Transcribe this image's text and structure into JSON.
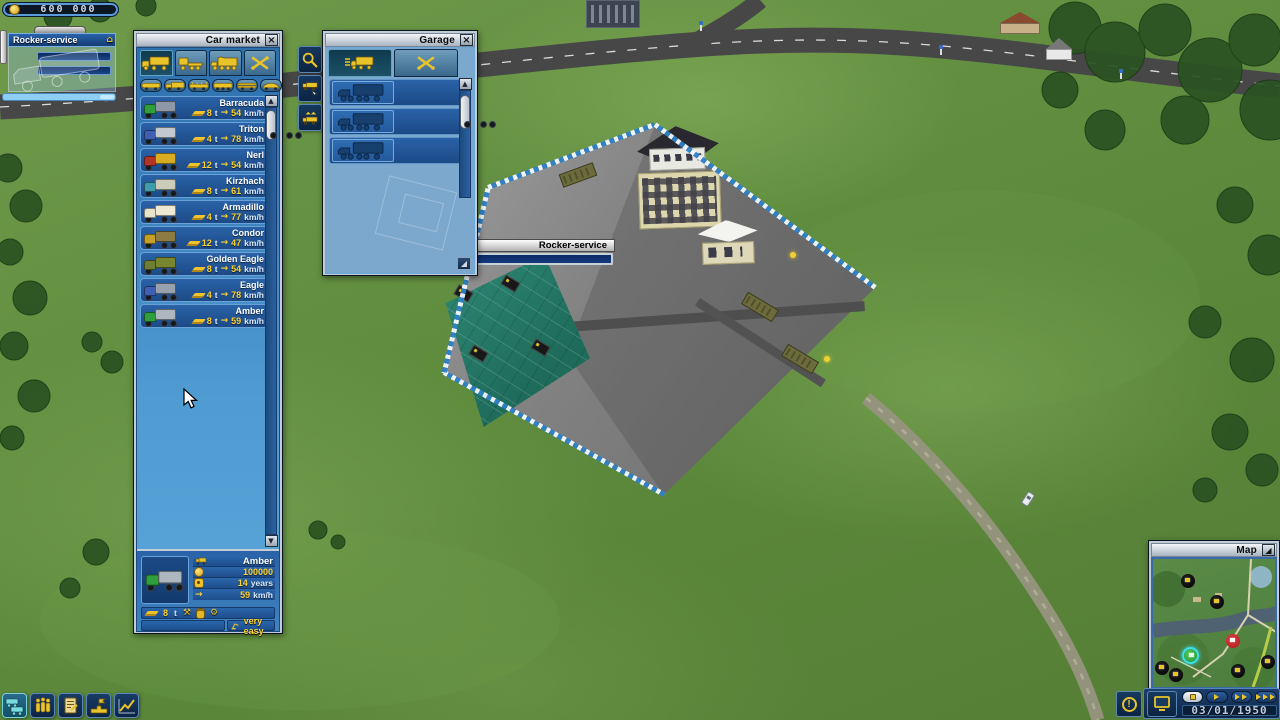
{
  "hud": {
    "money": "600 000",
    "date": "03/01/1950"
  },
  "vehicle_panel": {
    "title": "Rocker-service"
  },
  "building_tooltip": {
    "title": "Rocker-service"
  },
  "car_market": {
    "title": "Car market",
    "tab_icons": [
      "box-truck",
      "tractor-truck",
      "covered-truck",
      "tools"
    ],
    "filter_icons": [
      "tanker-truck",
      "box-truck",
      "stake-truck",
      "long-tanker",
      "timber-truck",
      "car"
    ],
    "trucks": [
      {
        "name": "Barracuda",
        "capacity": "8",
        "capacity_unit": "t",
        "speed": "54",
        "speed_unit": "km/h",
        "cab_color": "#2f9e3c",
        "box_color": "#8e98a6"
      },
      {
        "name": "Triton",
        "capacity": "4",
        "capacity_unit": "t",
        "speed": "78",
        "speed_unit": "km/h",
        "cab_color": "#3f5fb2",
        "box_color": "#c2c8ce"
      },
      {
        "name": "Nerl",
        "capacity": "12",
        "capacity_unit": "t",
        "speed": "54",
        "speed_unit": "km/h",
        "cab_color": "#b23428",
        "box_color": "#d8ac22"
      },
      {
        "name": "Kirzhach",
        "capacity": "8",
        "capacity_unit": "t",
        "speed": "61",
        "speed_unit": "km/h",
        "cab_color": "#3f9cac",
        "box_color": "#ccccba"
      },
      {
        "name": "Armadillo",
        "capacity": "4",
        "capacity_unit": "t",
        "speed": "77",
        "speed_unit": "km/h",
        "cab_color": "#e6e2cc",
        "box_color": "#efe9d4"
      },
      {
        "name": "Condor",
        "capacity": "12",
        "capacity_unit": "t",
        "speed": "47",
        "speed_unit": "km/h",
        "cab_color": "#c4a026",
        "box_color": "#8c7c44"
      },
      {
        "name": "Golden Eagle",
        "capacity": "8",
        "capacity_unit": "t",
        "speed": "54",
        "speed_unit": "km/h",
        "cab_color": "#6e7e34",
        "box_color": "#77862f"
      },
      {
        "name": "Eagle",
        "capacity": "4",
        "capacity_unit": "t",
        "speed": "78",
        "speed_unit": "km/h",
        "cab_color": "#3f5fb2",
        "box_color": "#98a2ae"
      },
      {
        "name": "Amber",
        "capacity": "8",
        "capacity_unit": "t",
        "speed": "59",
        "speed_unit": "km/h",
        "cab_color": "#2f9e3c",
        "box_color": "#aeb6c0"
      }
    ],
    "selected": {
      "name": "Amber",
      "price": "100000",
      "age": "14",
      "age_unit": "years",
      "speed": "59",
      "speed_unit": "km/h",
      "capacity": "8",
      "capacity_unit": "t",
      "difficulty": "very easy"
    }
  },
  "garage": {
    "title": "Garage",
    "tab_icons": [
      "vehicle-list",
      "repair-tools"
    ],
    "side_buttons": [
      "find-vehicle",
      "take-vehicle",
      "sell-vehicle"
    ],
    "slot_count": 3
  },
  "map_window": {
    "title": "Map"
  },
  "time_controls": {
    "buttons": [
      "pause",
      "play",
      "fast",
      "fastest"
    ],
    "active_speed": "pause"
  },
  "toolbar": [
    "vehicles",
    "staff",
    "contracts",
    "company",
    "statistics"
  ],
  "colors": {
    "accent_yellow": "#e8c32a",
    "value_yellow": "#ffd22e",
    "panel_blue": "#2e6fae",
    "active_cyan": "#3ae0ec",
    "alert_red": "#cc2020"
  },
  "icons": {
    "close": "×",
    "scroll_up": "▲",
    "scroll_down": "▼",
    "speed_arrow": "→",
    "gear": "⚙",
    "tools": "⚒",
    "alert": "!",
    "home": "⌂",
    "resize": "◢"
  }
}
